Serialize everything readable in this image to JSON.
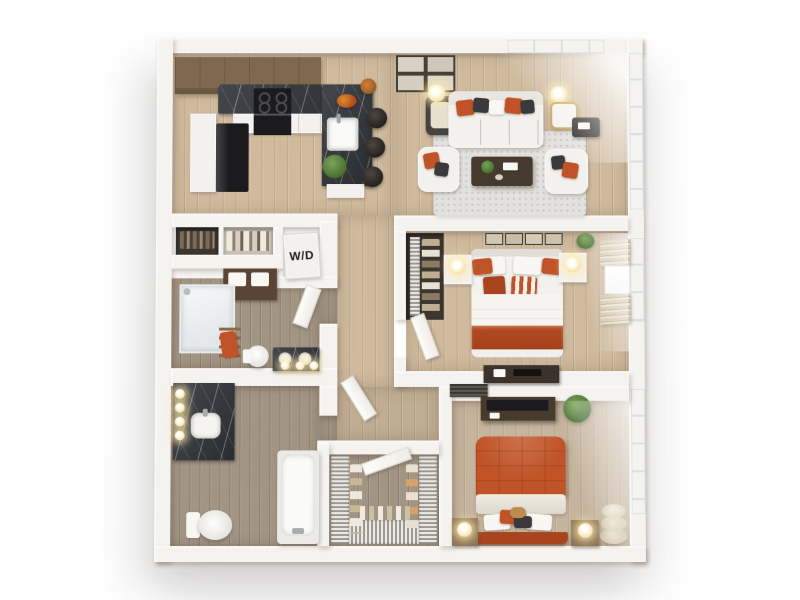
{
  "meta": {
    "image_type": "3D apartment floor plan rendering",
    "view": "top-down",
    "background": "#ffffff",
    "bedrooms": 2,
    "bathrooms": 2
  },
  "labels": {
    "washer_dryer": "W/D"
  },
  "palette": {
    "wall": "#f5f3f0",
    "floor_light": "#cfba9e",
    "floor_dark": "#a39584",
    "marble_dark": "#33363c",
    "cabinet_brown": "#7e6950",
    "accent_orange": "#c05327",
    "accent_orange_deep": "#a8441f",
    "furniture_white": "#f3f1ed",
    "dark_furniture": "#1b1b1d",
    "rug_gray": "#e2e1de",
    "lamp_glow": "#f6e2ac",
    "plant_green": "#4c7434",
    "window_light": "#fdfdfd",
    "blind_beige": "#d3c5ab",
    "wood_console": "#473a2f"
  },
  "rooms": [
    {
      "name": "kitchen",
      "features": [
        "L-shaped dark marble counter with island",
        "cooktop and oven",
        "black refrigerator",
        "wood upper cabinets",
        "3 bar stools",
        "island sink",
        "fruit bowl",
        "potted plant"
      ]
    },
    {
      "name": "living-room",
      "features": [
        "white sofa with orange and charcoal pillows",
        "2 white armchairs",
        "wood coffee table",
        "speckled area rug",
        "glowing floor lamps",
        "dark accent chair",
        "side table",
        "4 framed prints",
        "corner floor-to-ceiling windows",
        "gold-frame chair by window"
      ]
    },
    {
      "name": "laundry-closet",
      "features": [
        "stacked washer/dryer labeled W/D"
      ]
    },
    {
      "name": "hall-closets",
      "features": [
        "closet with hanging rod",
        "linen shelves",
        "console with white storage bins"
      ]
    },
    {
      "name": "bathroom-1",
      "features": [
        "glass shower",
        "toilet",
        "double-sink dark vanity with sconces",
        "towel ladder with orange towel"
      ]
    },
    {
      "name": "bedroom-1",
      "features": [
        "bed with white duvet and orange pillows",
        "2 nightstands with glowing lamps",
        "4 framed prints above bed",
        "open wire-shelf closet",
        "window with beige blinds",
        "dark dresser"
      ]
    },
    {
      "name": "bathroom-2",
      "features": [
        "dark marble vanity with glowing sconces",
        "toilet",
        "bathtub"
      ]
    },
    {
      "name": "walk-in-closet",
      "features": [
        "U-shaped wire shelving with hanging clothes"
      ]
    },
    {
      "name": "bedroom-2",
      "features": [
        "bed with orange quilted comforter",
        "2 wood nightstands with round lamps",
        "media console with TV",
        "potted plant",
        "stacked cream poufs",
        "floor-to-ceiling window",
        "wall vent"
      ]
    }
  ]
}
